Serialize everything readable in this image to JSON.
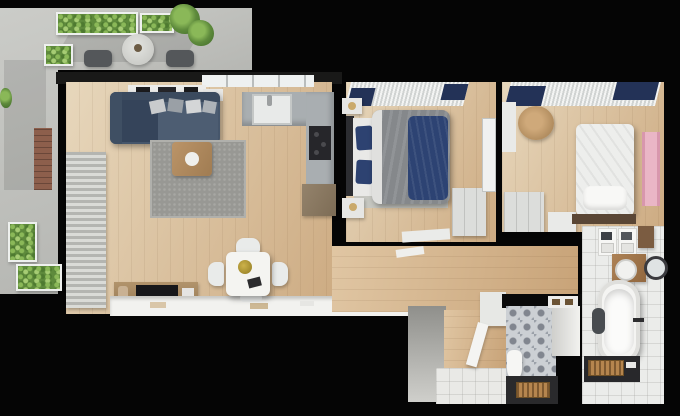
{
  "meta": {
    "type": "3d-floor-plan-render",
    "view": "top-down",
    "description": "Photorealistic top-down 3D render of a two-bedroom apartment with wrap-around terrace, black exterior walls and wooden floors"
  },
  "palette": {
    "background": "#050505",
    "wall_black": "#0a0a0a",
    "wood_light": "#e7d7bc",
    "wood_dark": "#cdab82",
    "terrace_concrete": "#c7c8c4",
    "plant_green": "#6f9c44",
    "sofa_navy": "#46566b",
    "bed_navy_throw": "#2d4373",
    "duvet_gray": "#85888b",
    "blind_navy": "#233257",
    "kitchen_counter_gray": "#a9aeb1",
    "white_furniture": "#eceded",
    "rug_gray": "#989894",
    "rug_tan": "#b5854e",
    "pink_mat": "#eab6c6",
    "dark_counter": "#28282b"
  },
  "rooms": [
    {
      "id": "terrace",
      "label": "Terrace",
      "items": [
        "planter row",
        "planter",
        "side planter",
        "hanging plant",
        "round table",
        "chair",
        "chair",
        "brick wall"
      ]
    },
    {
      "id": "living-room",
      "label": "Living room",
      "items": [
        "corner sofa",
        "cushions",
        "area rug",
        "coffee table",
        "wall shelf",
        "radiator panel",
        "media console",
        "tv",
        "work counter",
        "dining table",
        "dining chair",
        "centerpiece"
      ]
    },
    {
      "id": "kitchen",
      "label": "Kitchen",
      "items": [
        "window",
        "sink",
        "counter",
        "cooktop",
        "base cabinet"
      ]
    },
    {
      "id": "bedroom-master",
      "label": "Master bedroom",
      "items": [
        "window blinds",
        "double bed",
        "navy throw",
        "pillows",
        "nightstand",
        "bedside rug",
        "wardrobe",
        "mirror",
        "bench"
      ]
    },
    {
      "id": "bedroom-second",
      "label": "Second bedroom",
      "items": [
        "window blinds",
        "single bed",
        "pillow",
        "foot bench",
        "round chair",
        "wall shelf",
        "wardrobe",
        "dresser",
        "pink runner"
      ]
    },
    {
      "id": "corridor",
      "label": "Hallway",
      "items": [
        "wood floor",
        "papers"
      ]
    },
    {
      "id": "entrance",
      "label": "Entrance",
      "items": [
        "wall",
        "wood floor",
        "tile floor",
        "wardrobe",
        "open door"
      ]
    },
    {
      "id": "wc",
      "label": "WC",
      "items": [
        "patterned tile floor",
        "toilet",
        "vanity wall",
        "mirror frames",
        "dark floor",
        "rug"
      ]
    },
    {
      "id": "bathroom",
      "label": "Bathroom",
      "items": [
        "towel shelves",
        "wooden box",
        "washbasin",
        "round mirror",
        "bathtub",
        "towel",
        "faucet",
        "dark counter",
        "rug"
      ]
    }
  ]
}
